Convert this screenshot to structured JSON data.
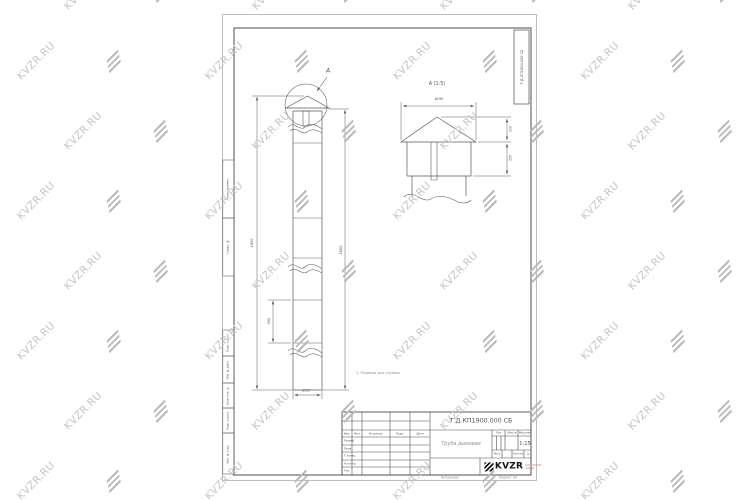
{
  "watermark": {
    "text": "KVZR.RU",
    "text_color": "#c6c6c6",
    "glyph_color": "#b9b9b9"
  },
  "sheet": {
    "corner_stamp": "Т.Д.КП1900.000 СБ",
    "margin_labels": [
      "Перв. примен.",
      "Справ. №",
      "Подп. и дата",
      "Инв. № дубл.",
      "Взам. инв. №",
      "Подп. и дата",
      "Инв. № подл."
    ],
    "footer_copy": "Копировал",
    "footer_format": "Формат А4"
  },
  "drawing": {
    "note": "1. Размеры для справок.",
    "front_view": {
      "detail_mark": "А",
      "dim_left": "1900",
      "dim_right": "1800",
      "dim_segment": "500",
      "dim_base": "ø150"
    },
    "detail_view": {
      "title": "А (1:5)",
      "dim_width": "ø190",
      "dim_roof_h": "120",
      "dim_skirt_h": "155"
    }
  },
  "title_block": {
    "doc_number": "Т.Д.КП1900.000 СБ",
    "part_name": "Труба дымовая",
    "rev_cols": [
      "Изм.",
      "Лист",
      "№ докум.",
      "Подп.",
      "Дата"
    ],
    "sig_rows": [
      "Разраб.",
      "Пров.",
      "Т.контр.",
      "Н.контр.",
      "Утв."
    ],
    "lit_label": "Лит.",
    "mass_label": "Масса",
    "scale_label": "Масштаб",
    "scale_value": "1:15",
    "sheet_label": "Лист",
    "sheets_label": "Листов",
    "sheets_value": "1",
    "logo_text": "KVZR",
    "logo_tag1": "КОТЕЛЬНЫЙ",
    "logo_tag2": "ЗАВОД"
  }
}
